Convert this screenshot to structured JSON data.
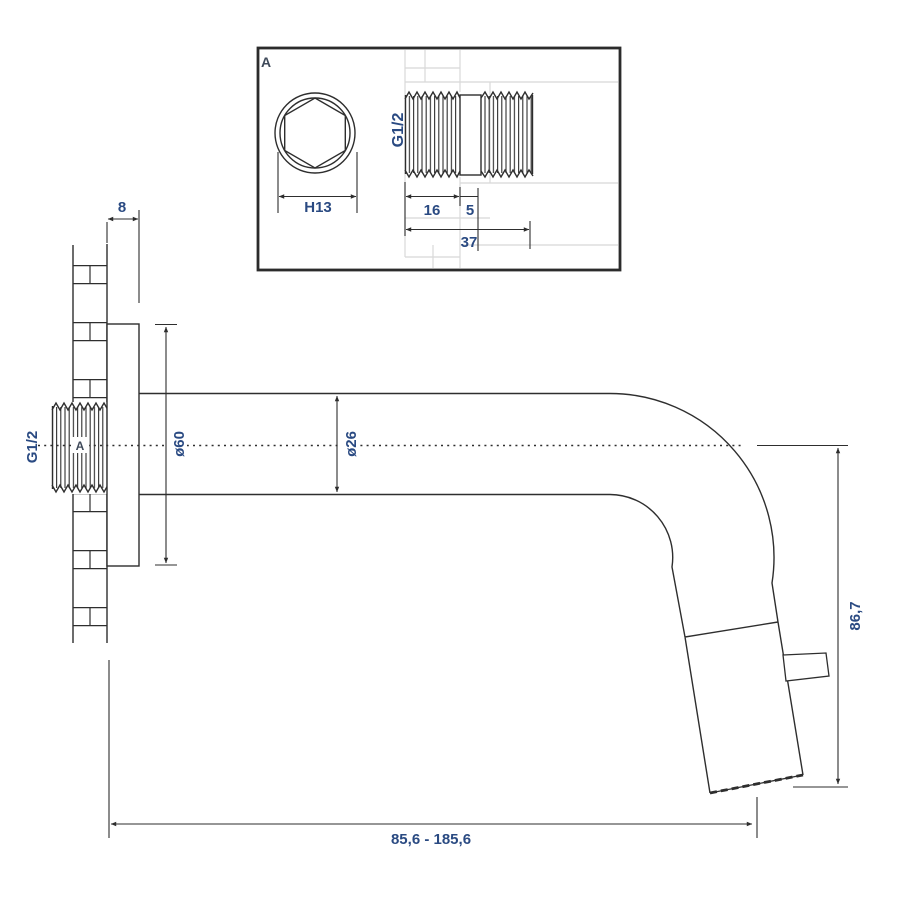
{
  "colors": {
    "line": "#2e2e2e",
    "dimension_text": "#2a4a82",
    "label_text": "#3f4a5a",
    "construction_line": "#d8d8d8",
    "background": "#ffffff"
  },
  "detail_box": {
    "label": "A",
    "hex_width": "H13",
    "thread_size": "G1/2",
    "thread_length": "16",
    "collar_length": "5",
    "total_length": "37"
  },
  "main_view": {
    "thread_size": "G1/2",
    "detail_ref": "A",
    "plate_thickness": "8",
    "plate_diameter": "ø60",
    "spout_diameter": "ø26",
    "spout_height": "86,7",
    "spout_reach": "85,6 - 185,6"
  }
}
